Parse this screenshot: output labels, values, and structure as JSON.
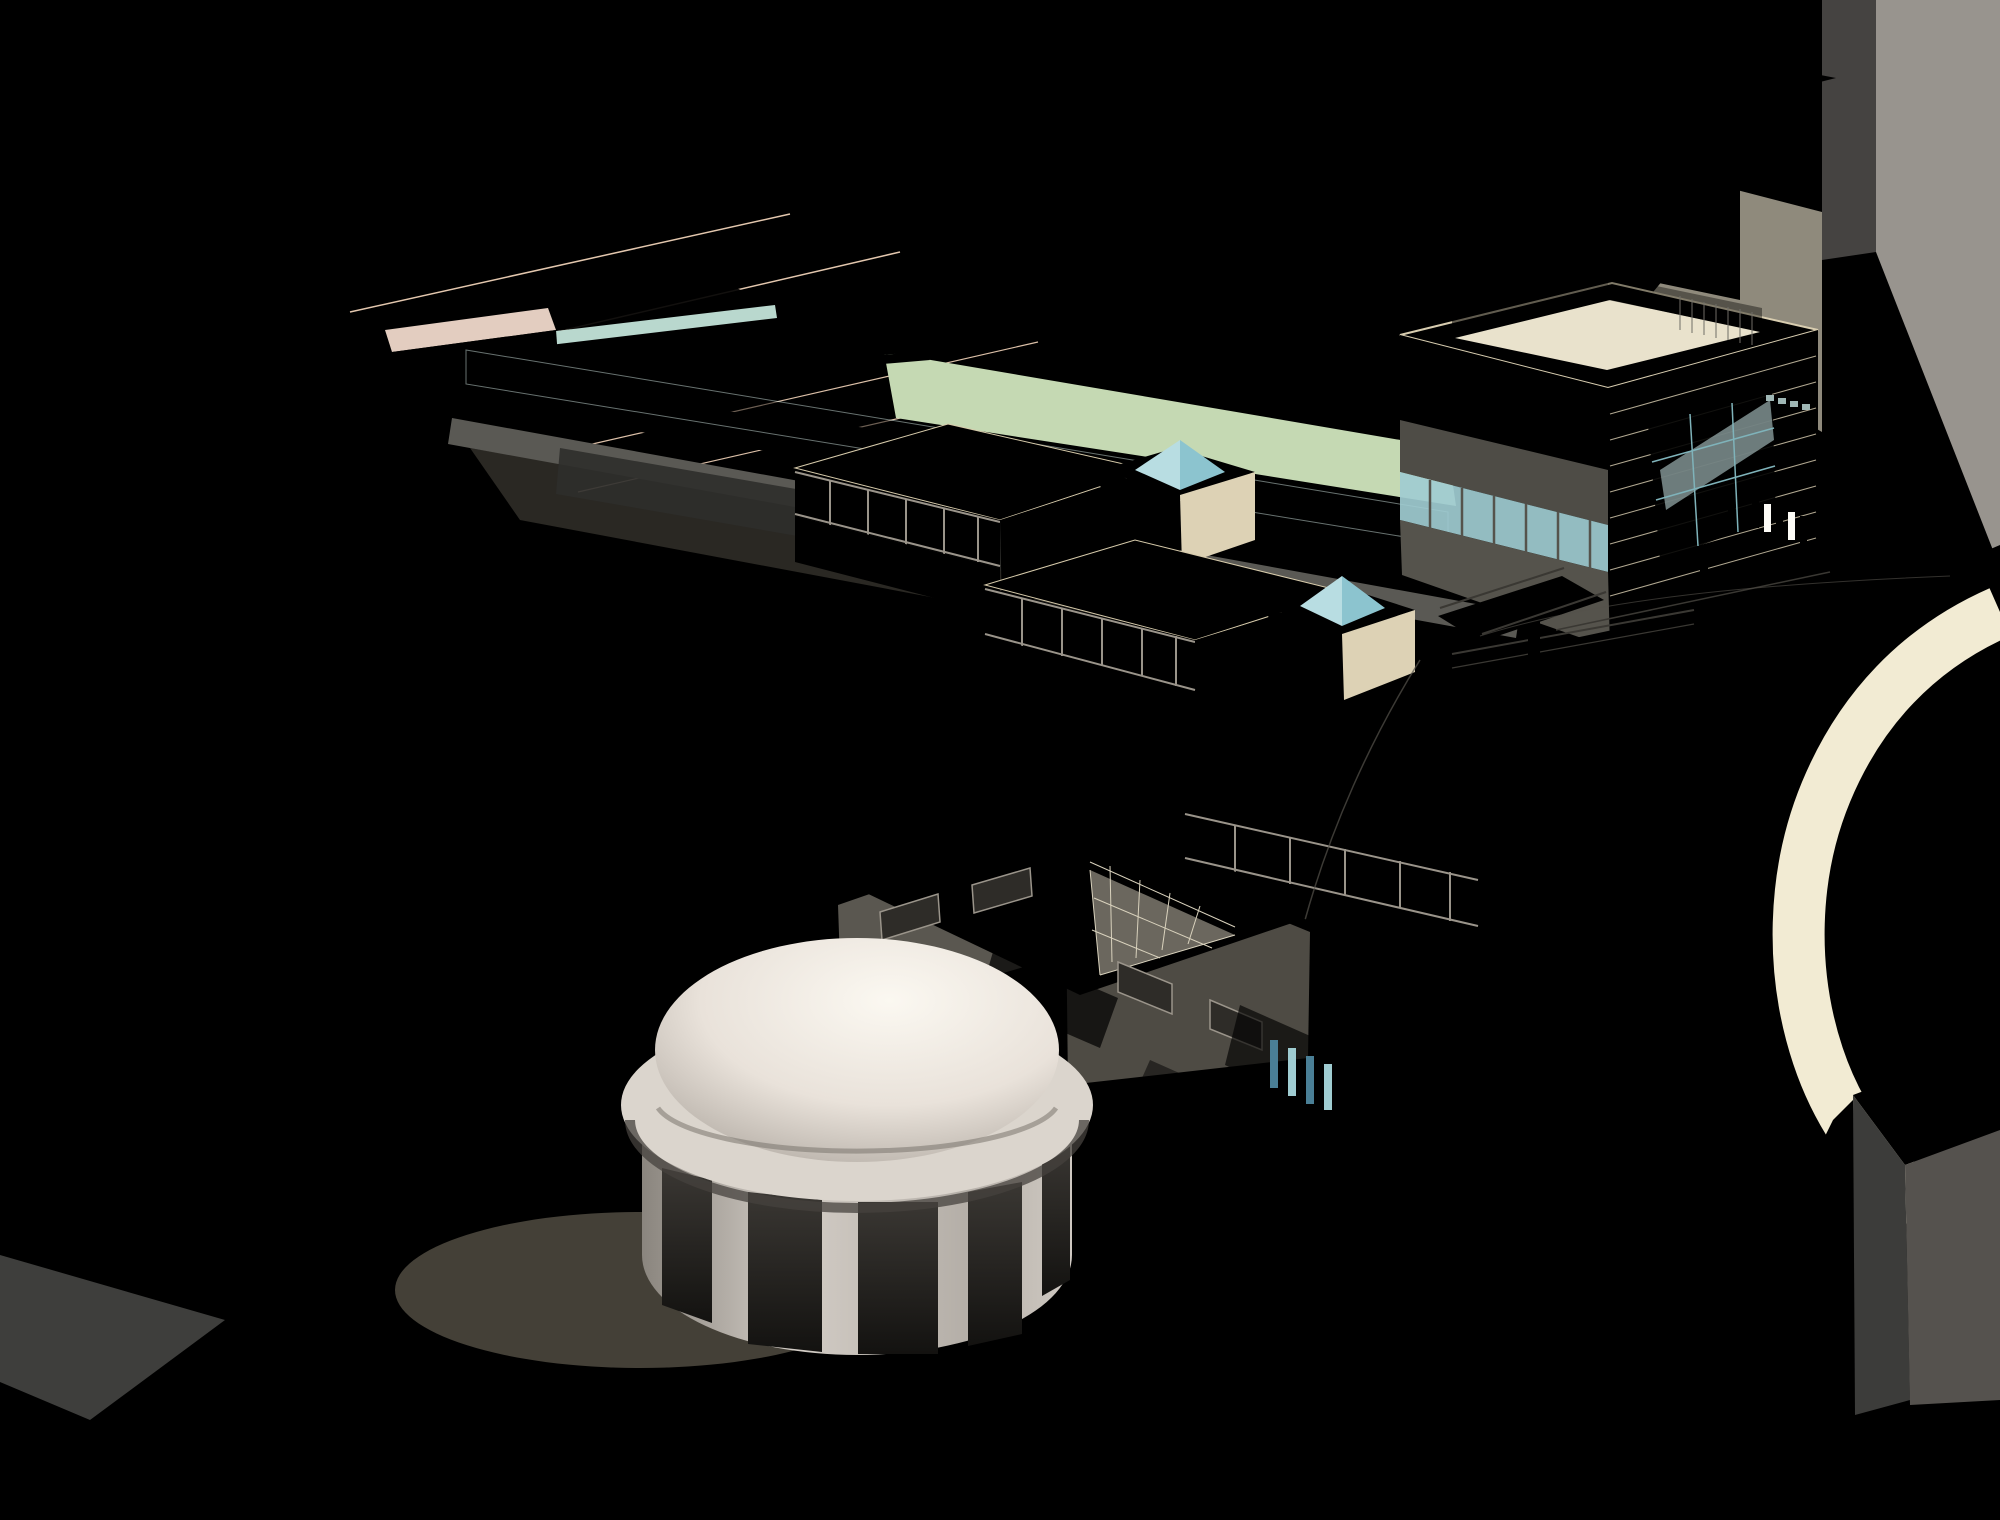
{
  "palette": {
    "ground": "#f2ebd3",
    "ground2": "#f6f0db",
    "grass": "#aecf9b",
    "grass2": "#9fc48c",
    "sage": "#99a88b",
    "road": "#7b7872",
    "rail": "#f2ede0",
    "roofL": "#b8b4af",
    "roofL2": "#c9c5c0",
    "wallD": "#47484a",
    "wallM": "#8f8c87",
    "wallL": "#a8a4a0",
    "charcoal": "#3e3e3e",
    "charcoal2": "#4b4b4a",
    "taupeD": "#6b6057",
    "salmonT": "#f5dfca",
    "salmonF": "#eccfba",
    "salmonM": "#e2c3ad",
    "pinkC": "#dcc3b5",
    "stone": "#ece3c9",
    "stoneL": "#f3ecd6",
    "stoneLine": "#d7cbab",
    "bandD": "#45423c",
    "frameL": "#9a948a",
    "glass": "#a9d3d6",
    "glassL": "#cfe4df",
    "glassD": "#8fc6cf",
    "pool": "#1f7fae",
    "poolL": "#7db9cd",
    "tree": "#9cc48c",
    "treeL": "#bada9f",
    "treeD": "#83af74",
    "trunk": "#2f2a1e",
    "domeHi": "#faf6ef",
    "domeLo": "#b3aca5",
    "drumHi": "#ccc6bf",
    "drumLo": "#8f8a83",
    "opening": "#1d1b19",
    "shadow": "#a9a08a",
    "red": "#8f1f1a",
    "blue": "#2a6f8e",
    "yellow": "#d4ab00",
    "white": "#f6f3ea",
    "dark": "#3a3833"
  },
  "scene": {
    "track_center_d": "M 2000 598 C 1868 608 1738 628 1640 682 C 1542 736 1486 806 1452 886 C 1418 966 1404 1064 1412 1148 C 1420 1232 1452 1302 1524 1362 C 1612 1432 1780 1470 2000 1492",
    "track": {
      "offsets": [
        -30,
        -12,
        12,
        30
      ],
      "width": 2.6
    },
    "trees_round": [
      [
        565,
        205,
        62
      ],
      [
        640,
        162,
        56
      ],
      [
        706,
        256,
        58
      ],
      [
        776,
        216,
        62
      ],
      [
        842,
        188,
        50
      ],
      [
        876,
        300,
        52
      ],
      [
        928,
        262,
        48
      ],
      [
        700,
        332,
        46
      ],
      [
        1006,
        420,
        46
      ],
      [
        1062,
        458,
        44
      ],
      [
        352,
        346,
        52
      ],
      [
        448,
        332,
        50
      ],
      [
        760,
        566,
        42
      ],
      [
        906,
        602,
        40
      ],
      [
        1082,
        746,
        45
      ],
      [
        700,
        990,
        46
      ],
      [
        936,
        1036,
        44
      ],
      [
        1110,
        938,
        42
      ],
      [
        1444,
        926,
        40
      ],
      [
        1482,
        738,
        36
      ],
      [
        148,
        1098,
        55
      ],
      [
        224,
        1162,
        56
      ],
      [
        306,
        1232,
        56
      ],
      [
        398,
        1302,
        56
      ],
      [
        490,
        1242,
        52
      ],
      [
        434,
        1128,
        46
      ],
      [
        524,
        1186,
        44
      ],
      [
        434,
        1312,
        54
      ],
      [
        524,
        1302,
        50
      ],
      [
        570,
        1244,
        48
      ],
      [
        662,
        1346,
        56
      ],
      [
        774,
        1314,
        52
      ],
      [
        882,
        1354,
        54
      ],
      [
        982,
        1284,
        50
      ],
      [
        1044,
        1198,
        48
      ],
      [
        1094,
        1094,
        46
      ],
      [
        252,
        1478,
        48
      ],
      [
        356,
        1442,
        44
      ]
    ],
    "trees_columnar": [
      [
        1558,
        622,
        100
      ],
      [
        1512,
        662,
        100
      ],
      [
        1466,
        707,
        105
      ],
      [
        1426,
        757,
        105
      ],
      [
        1390,
        812,
        108
      ],
      [
        1358,
        868,
        108
      ],
      [
        1330,
        928,
        108
      ],
      [
        1305,
        988,
        106
      ],
      [
        1283,
        1050,
        104
      ],
      [
        1264,
        1112,
        102
      ],
      [
        1249,
        1174,
        100
      ],
      [
        1238,
        1236,
        96
      ],
      [
        1620,
        592,
        95
      ],
      [
        1672,
        566,
        88
      ],
      [
        1002,
        530,
        120
      ],
      [
        1168,
        552,
        125
      ],
      [
        1334,
        588,
        130
      ]
    ],
    "banners": [
      {
        "x": 1520,
        "y": 602,
        "c": "red"
      },
      {
        "x": 1556,
        "y": 568,
        "c": "blue"
      },
      {
        "x": 1450,
        "y": 722,
        "c": "red"
      },
      {
        "x": 1468,
        "y": 680,
        "c": "blue"
      },
      {
        "x": 1392,
        "y": 784,
        "c": "blue"
      },
      {
        "x": 1358,
        "y": 836,
        "c": "red"
      }
    ],
    "planters": [
      [
        965,
        436,
        52,
        20
      ],
      [
        1105,
        452,
        56,
        22
      ],
      [
        1258,
        482,
        60,
        23
      ],
      [
        1372,
        508,
        48,
        19
      ]
    ],
    "post_runs": [
      {
        "x1": 470,
        "y1": 366,
        "x2": 1440,
        "y2": 527,
        "n": 30,
        "h": 34,
        "c": "white"
      },
      {
        "x1": 884,
        "y1": 330,
        "x2": 1426,
        "y2": 424,
        "n": 16,
        "h": 28,
        "c": "white"
      },
      {
        "x1": 556,
        "y1": 336,
        "x2": 772,
        "y2": 308,
        "n": 4,
        "h": 78,
        "c": "white"
      },
      {
        "x1": 392,
        "y1": 386,
        "x2": 552,
        "y2": 364,
        "n": 5,
        "h": 46,
        "c": "white"
      },
      {
        "x1": 520,
        "y1": 448,
        "x2": 1200,
        "y2": 560,
        "n": 8,
        "h": 104,
        "c": "mid"
      },
      {
        "x1": 1455,
        "y1": 318,
        "x2": 1607,
        "y2": 282,
        "n": 8,
        "h": 26,
        "c": "dark"
      },
      {
        "x1": 1607,
        "y1": 282,
        "x2": 1760,
        "y2": 316,
        "n": 8,
        "h": 26,
        "c": "dark"
      },
      {
        "x1": 1442,
        "y1": 610,
        "x2": 1596,
        "y2": 590,
        "n": 8,
        "h": 14,
        "c": "dark"
      },
      {
        "x1": 1556,
        "y1": 632,
        "x2": 1826,
        "y2": 574,
        "n": 12,
        "h": 12,
        "c": "dark"
      },
      {
        "x1": 1452,
        "y1": 656,
        "x2": 1694,
        "y2": 612,
        "n": 10,
        "h": 12,
        "c": "dark"
      }
    ],
    "step_runs": [
      {
        "x1": 1318,
        "y1": 572,
        "x2": 1455,
        "y2": 538,
        "n": 8,
        "dx": 0,
        "dy": 9
      },
      {
        "x1": 1098,
        "y1": 450,
        "x2": 1176,
        "y2": 432,
        "n": 6,
        "dx": 0,
        "dy": 7
      },
      {
        "x1": 995,
        "y1": 762,
        "x2": 1078,
        "y2": 738,
        "n": 6,
        "dx": 0,
        "dy": 8
      },
      {
        "x1": 1150,
        "y1": 1048,
        "x2": 1218,
        "y2": 1026,
        "n": 6,
        "dx": 4,
        "dy": 7
      }
    ],
    "yellow_stripes": [
      [
        592,
        468,
        758,
        490
      ],
      [
        1072,
        546,
        1338,
        598
      ]
    ],
    "shelters": [
      {
        "x": 1366,
        "y": 972
      },
      {
        "x": 1458,
        "y": 992
      }
    ],
    "poles": [
      {
        "x": 1572,
        "y1": 512,
        "y2": 612,
        "arm": [
          1518,
          540,
          1636,
          552
        ]
      },
      {
        "x": 1438,
        "y1": 930,
        "y2": 1050,
        "arm": [
          1414,
          948,
          1462,
          958
        ]
      },
      {
        "x": 1530,
        "y1": 900,
        "y2": 1020,
        "arm": [
          1506,
          918,
          1554,
          928
        ]
      }
    ]
  }
}
